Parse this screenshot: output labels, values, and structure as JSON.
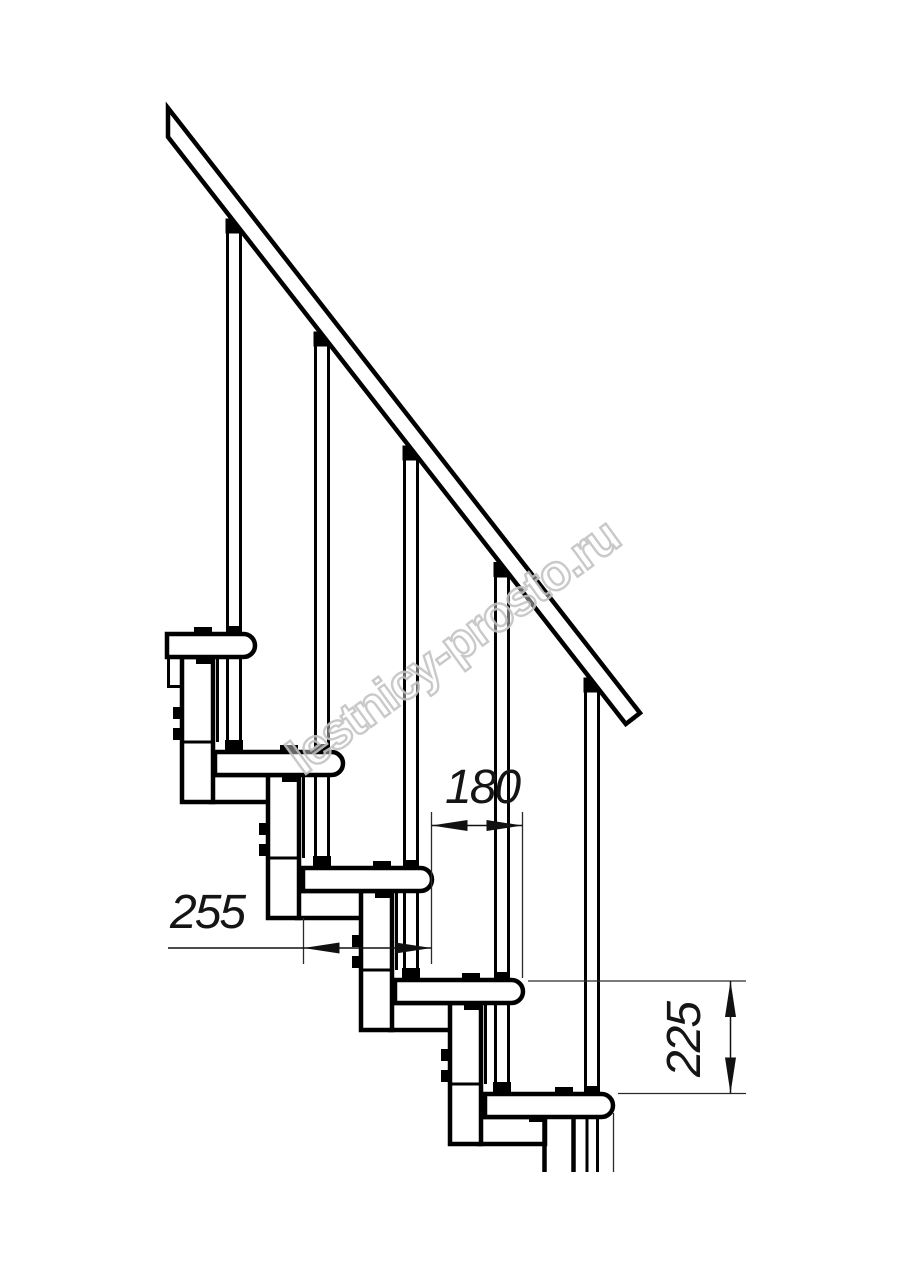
{
  "drawing": {
    "watermark": {
      "text": "lestnicy-prosto.ru",
      "color": "#c4c4c4"
    },
    "dimensions": {
      "going": {
        "value": "180"
      },
      "tread_depth": {
        "value": "255"
      },
      "rise": {
        "value": "225"
      }
    },
    "colors": {
      "outline": "#000000",
      "background": "#ffffff",
      "dimension_line": "#111111"
    }
  }
}
